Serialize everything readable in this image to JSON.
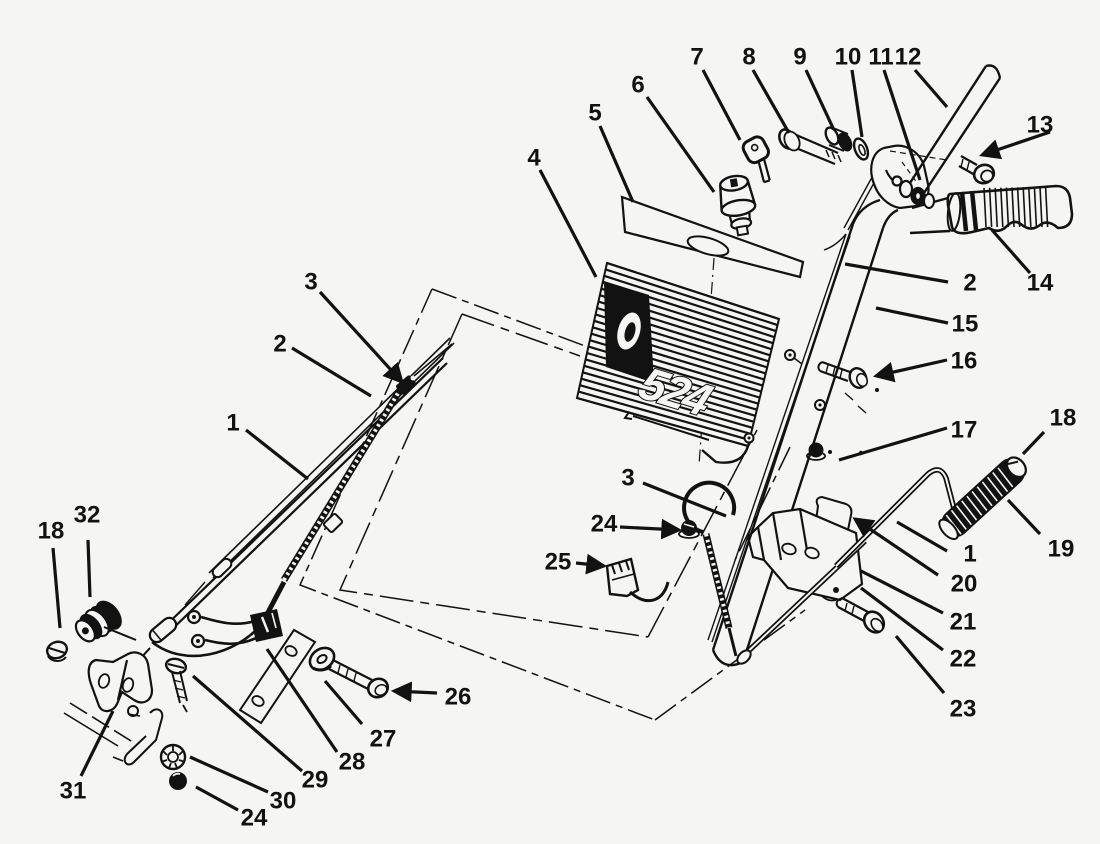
{
  "figure": {
    "model_number": "524",
    "background": "#f5f5f4",
    "ink": "#121212",
    "description": "exploded-parts-diagram-handle-assembly"
  },
  "callouts": [
    {
      "id": "7",
      "label": "7",
      "x": 697,
      "y": 57,
      "leader": [
        703,
        70,
        740,
        140
      ],
      "arrow": false
    },
    {
      "id": "8",
      "label": "8",
      "x": 749,
      "y": 57,
      "leader": [
        753,
        70,
        789,
        133
      ],
      "arrow": false
    },
    {
      "id": "9",
      "label": "9",
      "x": 800,
      "y": 57,
      "leader": [
        806,
        70,
        833,
        128
      ],
      "arrow": false
    },
    {
      "id": "10",
      "label": "10",
      "x": 848,
      "y": 57,
      "leader": [
        852,
        70,
        862,
        137
      ],
      "arrow": false
    },
    {
      "id": "11",
      "label": "11",
      "x": 881,
      "y": 57,
      "leader": [
        884,
        70,
        920,
        180
      ],
      "arrow": false
    },
    {
      "id": "12",
      "label": "12",
      "x": 908,
      "y": 57,
      "leader": [
        915,
        70,
        947,
        107
      ],
      "arrow": false
    },
    {
      "id": "6",
      "label": "6",
      "x": 638,
      "y": 85,
      "leader": [
        647,
        97,
        714,
        192
      ],
      "arrow": false
    },
    {
      "id": "5",
      "label": "5",
      "x": 595,
      "y": 113,
      "leader": [
        600,
        126,
        633,
        202
      ],
      "arrow": false
    },
    {
      "id": "13",
      "label": "13",
      "x": 1040,
      "y": 125,
      "leader": [
        1050,
        132,
        982,
        155
      ],
      "arrow": true
    },
    {
      "id": "4",
      "label": "4",
      "x": 534,
      "y": 158,
      "leader": [
        540,
        170,
        596,
        277
      ],
      "arrow": false
    },
    {
      "id": "2-right",
      "label": "2",
      "x": 970,
      "y": 283,
      "leader": [
        948,
        282,
        845,
        264
      ],
      "arrow": false
    },
    {
      "id": "14",
      "label": "14",
      "x": 1040,
      "y": 283,
      "leader": [
        1030,
        273,
        992,
        230
      ],
      "arrow": false
    },
    {
      "id": "15",
      "label": "15",
      "x": 965,
      "y": 324,
      "leader": [
        948,
        323,
        876,
        308
      ],
      "arrow": false
    },
    {
      "id": "16",
      "label": "16",
      "x": 964,
      "y": 361,
      "leader": [
        947,
        360,
        876,
        376
      ],
      "arrow": true
    },
    {
      "id": "17",
      "label": "17",
      "x": 964,
      "y": 430,
      "leader": [
        947,
        428,
        839,
        460
      ],
      "arrow": false
    },
    {
      "id": "18-right",
      "label": "18",
      "x": 1063,
      "y": 418,
      "leader": [
        1044,
        432,
        1023,
        454
      ],
      "arrow": false
    },
    {
      "id": "3-left",
      "label": "3",
      "x": 311,
      "y": 282,
      "leader": [
        320,
        292,
        402,
        382
      ],
      "arrow": true
    },
    {
      "id": "2-left",
      "label": "2",
      "x": 280,
      "y": 344,
      "leader": [
        292,
        348,
        371,
        396
      ],
      "arrow": false
    },
    {
      "id": "1-left",
      "label": "1",
      "x": 233,
      "y": 423,
      "leader": [
        246,
        430,
        308,
        479
      ],
      "arrow": false
    },
    {
      "id": "19",
      "label": "19",
      "x": 1061,
      "y": 549,
      "leader": [
        1040,
        534,
        1008,
        500
      ],
      "arrow": false
    },
    {
      "id": "1-right",
      "label": "1",
      "x": 970,
      "y": 554,
      "leader": [
        947,
        551,
        897,
        522
      ],
      "arrow": false
    },
    {
      "id": "20",
      "label": "20",
      "x": 964,
      "y": 584,
      "leader": [
        938,
        575,
        855,
        519
      ],
      "arrow": true
    },
    {
      "id": "21",
      "label": "21",
      "x": 963,
      "y": 622,
      "leader": [
        943,
        613,
        861,
        571
      ],
      "arrow": false
    },
    {
      "id": "22",
      "label": "22",
      "x": 963,
      "y": 659,
      "leader": [
        943,
        650,
        861,
        588
      ],
      "arrow": false
    },
    {
      "id": "23",
      "label": "23",
      "x": 963,
      "y": 709,
      "leader": [
        944,
        693,
        896,
        636
      ],
      "arrow": false
    },
    {
      "id": "3-mid",
      "label": "3",
      "x": 628,
      "y": 478,
      "leader": [
        643,
        483,
        726,
        516
      ],
      "arrow": false
    },
    {
      "id": "24-mid",
      "label": "24",
      "x": 604,
      "y": 524,
      "leader": [
        620,
        527,
        679,
        530
      ],
      "arrow": true
    },
    {
      "id": "25",
      "label": "25",
      "x": 558,
      "y": 562,
      "leader": [
        576,
        563,
        604,
        566
      ],
      "arrow": true
    },
    {
      "id": "26",
      "label": "26",
      "x": 458,
      "y": 697,
      "leader": [
        437,
        693,
        394,
        691
      ],
      "arrow": true
    },
    {
      "id": "27",
      "label": "27",
      "x": 383,
      "y": 739,
      "leader": [
        362,
        724,
        325,
        681
      ],
      "arrow": false
    },
    {
      "id": "28",
      "label": "28",
      "x": 352,
      "y": 762,
      "leader": [
        337,
        752,
        267,
        649
      ],
      "arrow": false
    },
    {
      "id": "29",
      "label": "29",
      "x": 315,
      "y": 780,
      "leader": [
        302,
        771,
        193,
        676
      ],
      "arrow": false
    },
    {
      "id": "30",
      "label": "30",
      "x": 283,
      "y": 801,
      "leader": [
        268,
        792,
        190,
        757
      ],
      "arrow": false
    },
    {
      "id": "24-bottom",
      "label": "24",
      "x": 254,
      "y": 818,
      "leader": [
        238,
        810,
        196,
        787
      ],
      "arrow": false
    },
    {
      "id": "31",
      "label": "31",
      "x": 73,
      "y": 791,
      "leader": [
        81,
        776,
        113,
        711
      ],
      "arrow": false
    },
    {
      "id": "18-left",
      "label": "18",
      "x": 51,
      "y": 531,
      "leader": [
        53,
        548,
        60,
        628
      ],
      "arrow": false
    },
    {
      "id": "32",
      "label": "32",
      "x": 87,
      "y": 515,
      "leader": [
        88,
        540,
        90,
        597
      ],
      "arrow": false
    }
  ]
}
